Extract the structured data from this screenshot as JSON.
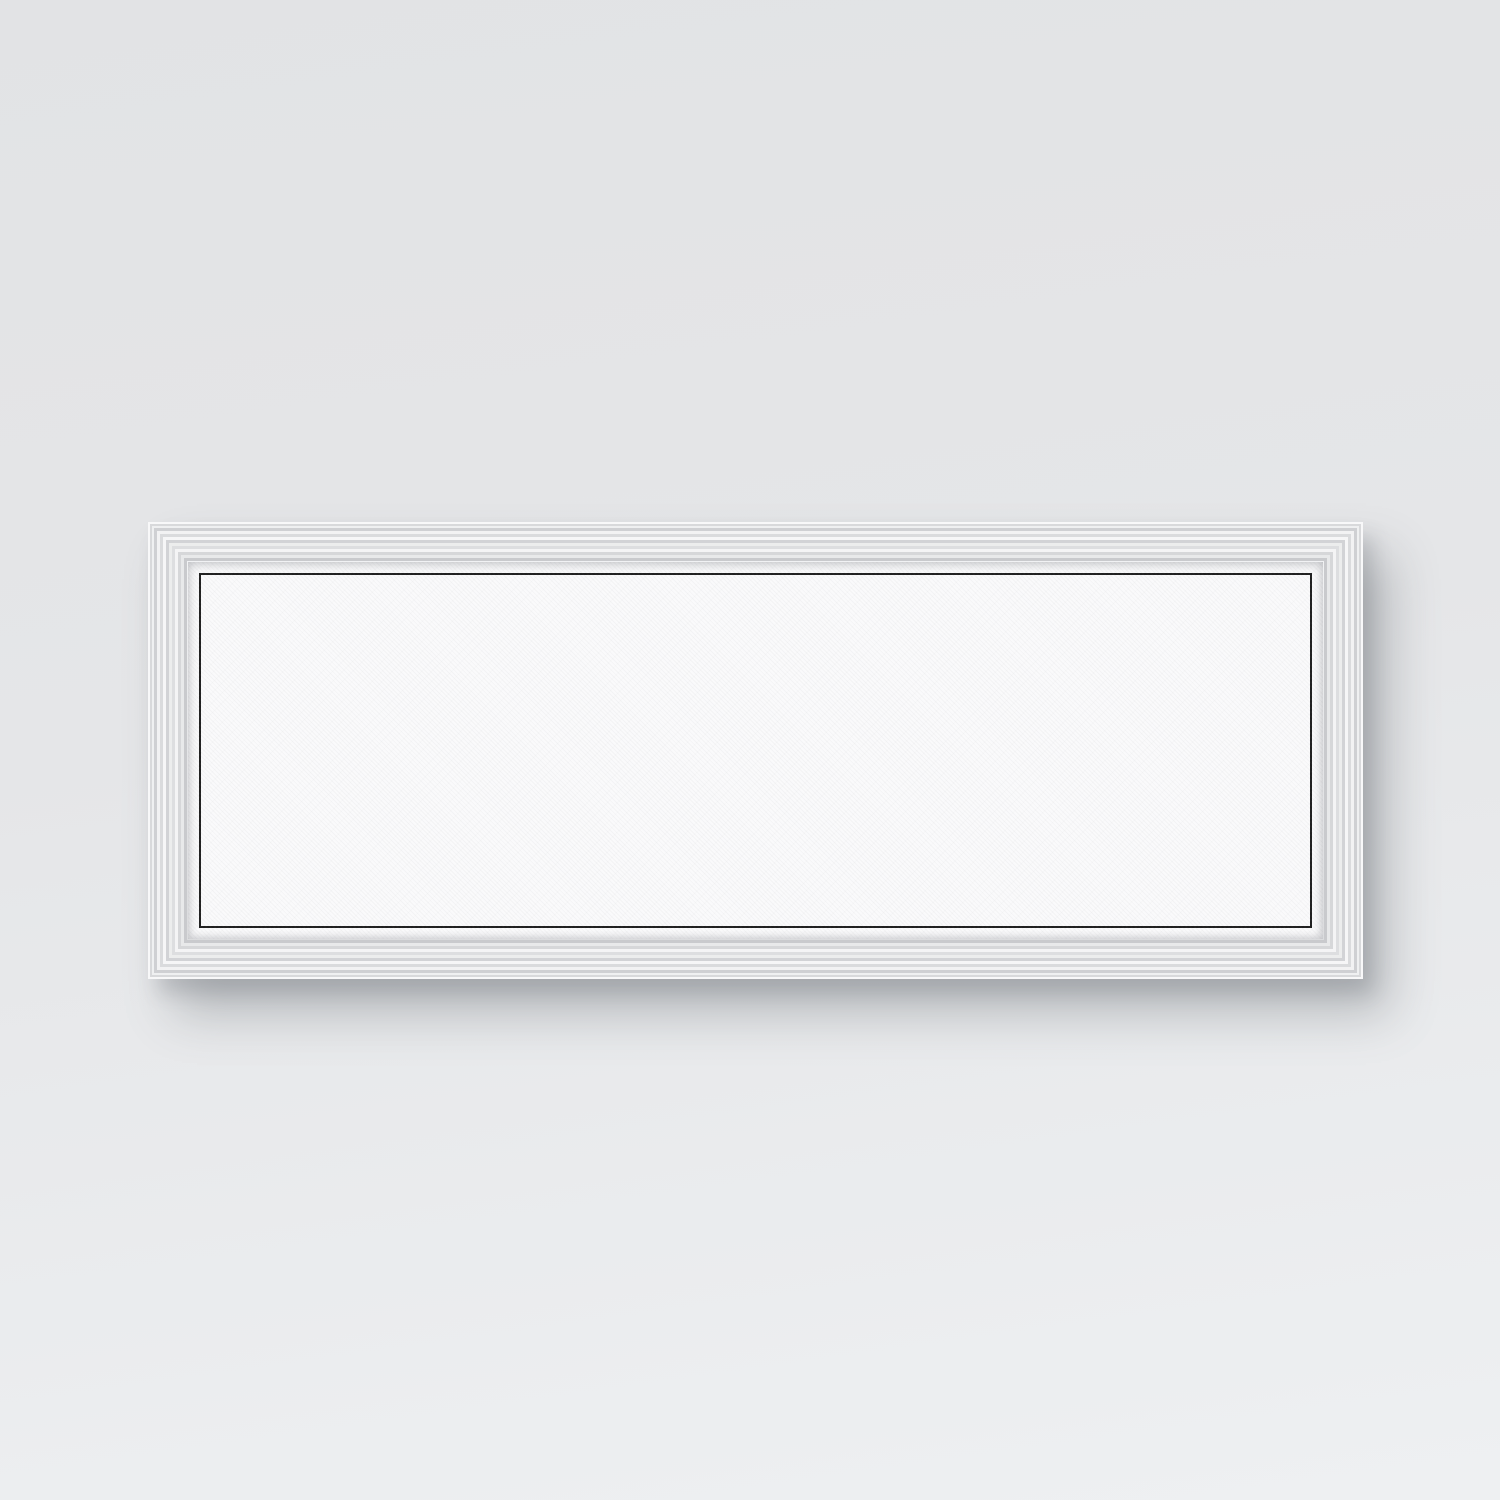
{
  "poster": {
    "city": "WICHITA",
    "coordinates": "37.69°N | 97.35°W",
    "state": "KANSAS",
    "text_color": "#262626"
  },
  "scene": {
    "wall_top_color": "#e2e3e5",
    "wall_bottom_color": "#eef0f2",
    "frame_finish": "whitewashed-silver-molding",
    "orientation": "panoramic",
    "shadow_color": "rgba(80,86,94,0.32)"
  },
  "map": {
    "width": 1118,
    "height": 360,
    "background": "#f6f6f8",
    "street_color": "#3c3c3c",
    "major_road_color": "#161616",
    "water_color": "#ffffff",
    "water_outline": "#9a9a9e",
    "gray_zone_color": "#dddee1",
    "seed": 1337,
    "grid": {
      "v_step": 49.5,
      "h_step": 48,
      "v_offset": 10,
      "h_offset": 23,
      "color": "#2d2d2d"
    },
    "fade": {
      "start_y": 128,
      "full_y": 240
    },
    "clusters": [
      {
        "name": "west-suburbs",
        "x": 8,
        "y": 4,
        "w": 337,
        "h": 221,
        "count": 850
      },
      {
        "name": "midtown-east",
        "x": 648,
        "y": 4,
        "w": 182,
        "h": 221,
        "count": 430
      },
      {
        "name": "east-suburbs",
        "x": 830,
        "y": 4,
        "w": 280,
        "h": 216,
        "count": 620
      },
      {
        "name": "southwest-sparse",
        "x": 8,
        "y": 180,
        "w": 192,
        "h": 80,
        "count": 120
      }
    ],
    "hatch_regions": [
      {
        "name": "downtown-grid",
        "x": 352,
        "y": 0,
        "w": 290,
        "h": 238,
        "v_step": 4.4,
        "h_step": 6.2,
        "skip": 0.18
      },
      {
        "name": "east-core-grid",
        "x": 642,
        "y": 4,
        "w": 190,
        "h": 226,
        "v_step": 7.2,
        "h_step": 9.0,
        "skip": 0.3
      }
    ],
    "random_patches": {
      "count": 26,
      "x_min": 8,
      "x_max": 1060,
      "y_min": 4,
      "y_max": 195,
      "w_min": 18,
      "w_max": 70,
      "h_min": 12,
      "h_max": 45
    },
    "gray_zones": [
      {
        "name": "airbase-block",
        "x": 858,
        "y": 66,
        "w": 52,
        "h": 92,
        "o": 0.9
      },
      {
        "name": "campus-block",
        "x": 700,
        "y": 56,
        "w": 26,
        "h": 34,
        "o": 0.45
      },
      {
        "name": "southwest-field",
        "x": 236,
        "y": 186,
        "w": 78,
        "h": 42,
        "o": 0.4
      },
      {
        "name": "northeast-field",
        "x": 962,
        "y": 28,
        "w": 42,
        "h": 26,
        "o": 0.35
      },
      {
        "name": "north-field",
        "x": 516,
        "y": 6,
        "w": 48,
        "h": 30,
        "o": 0.3
      },
      {
        "name": "south-field",
        "x": 418,
        "y": 196,
        "w": 90,
        "h": 34,
        "o": 0.35
      }
    ],
    "water_features": [
      {
        "name": "floodway-canal",
        "d": "M318 -6 C300 40 288 62 292 98 C296 128 306 142 308 174 C309 196 300 214 294 244 L290 300",
        "w": 12
      },
      {
        "name": "arkansas-river-upper",
        "d": "M470 -6 C462 14 434 18 430 40 C426 60 464 62 466 82 C468 100 430 102 428 122 C426 142 468 144 470 164 C471 178 458 186 454 202",
        "w": 9
      },
      {
        "name": "arkansas-river-lower",
        "d": "M454 202 C450 220 472 232 470 252 C468 276 462 292 463 330",
        "w": 6.5
      }
    ],
    "lakes": [
      {
        "name": "west-lake",
        "cx": 338,
        "cy": 40,
        "rx": 15,
        "ry": 24
      },
      {
        "name": "park-pond",
        "cx": 571,
        "cy": 27,
        "rx": 10,
        "ry": 7
      },
      {
        "name": "north-pond",
        "cx": 868,
        "cy": 26,
        "rx": 13,
        "ry": 8
      },
      {
        "name": "east-lake",
        "cx": 1052,
        "cy": 92,
        "rx": 18,
        "ry": 11
      }
    ],
    "major_roads": [
      {
        "name": "kellogg-us54",
        "d": "M-6 208 C120 200 230 186 330 178 C500 170 600 172 700 171 C850 169 980 172 1124 162",
        "w": 3.4
      },
      {
        "name": "i-135",
        "d": "M598 -6 C592 35 588 62 596 94 C606 130 624 152 622 192 C620 232 606 252 604 302 L603 366",
        "w": 3
      },
      {
        "name": "floodway-road",
        "d": "M322 -6 C304 42 292 64 296 98 C300 128 310 142 312 174",
        "w": 1.8
      },
      {
        "name": "k-96-diagonal",
        "d": "M1124 58 C1040 108 990 142 910 164 C888 169 872 170 860 170",
        "w": 2.6
      },
      {
        "name": "turnpike-wavy",
        "d": "M944 -6 C934 40 956 72 948 106 C942 132 956 150 950 172",
        "w": 1.8
      },
      {
        "name": "southwest-blvd",
        "d": "M330 178 C262 216 186 266 92 334",
        "w": 2.2
      },
      {
        "name": "southeast-branch",
        "d": "M612 212 C644 254 672 288 706 334",
        "w": 2.2
      },
      {
        "name": "rail-diagonal",
        "d": "M332 10 L478 124",
        "w": 1,
        "o": 0.6
      }
    ]
  }
}
